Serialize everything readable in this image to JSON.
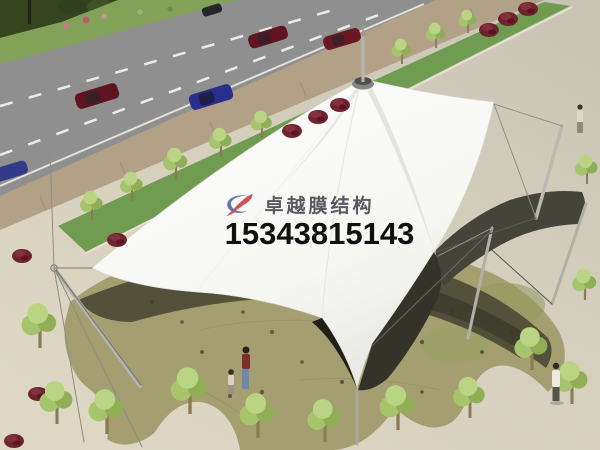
{
  "watermark": {
    "brand_text": "卓越膜结构",
    "phone_number": "15343815143"
  },
  "branding": {
    "logo_icon": "brand-swoosh-icon",
    "logo_red": "#c43c44",
    "logo_blue": "#5563a8",
    "brand_text_color": "#45454c",
    "phone_text_color": "#101010"
  },
  "scene": {
    "type": "architectural-rendering",
    "subject": "tensile membrane canopy structure over stone terrace beside road",
    "palette": {
      "plaza": "#d5cfbd",
      "road": "#8e8f8e",
      "sidewalk": "#b2a186",
      "median_grass": "#6f9c50",
      "verge_grass": "#82a258",
      "hedge": "#35431f",
      "terrace_stone": "#a59e70",
      "canopy_shadow": "#4f4d37",
      "canopy_white": "#fbfbf9",
      "bush_maroon": "#6e2430",
      "tree_green": "#a5c46c",
      "car_red": "#5f1420",
      "car_blue": "#2a2f8e",
      "mast_steel": "#b5b5ae"
    }
  }
}
